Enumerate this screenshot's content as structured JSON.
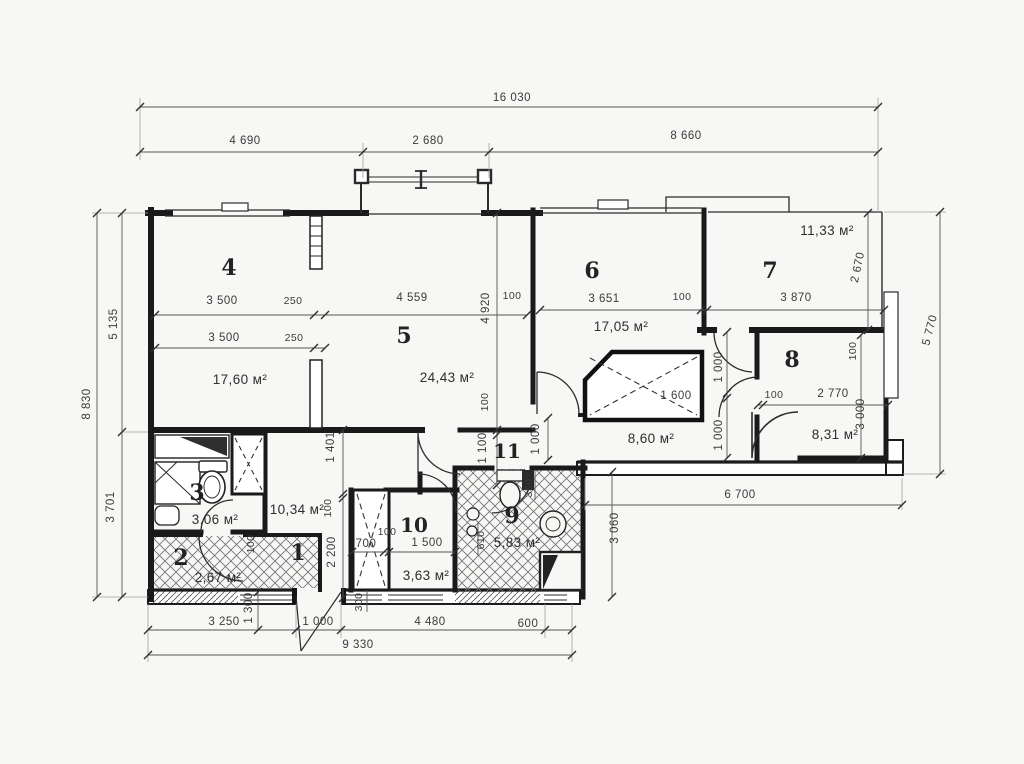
{
  "rooms": [
    {
      "number": "1",
      "area": "10,34 м²"
    },
    {
      "number": "2",
      "area": "2,67 м²"
    },
    {
      "number": "3",
      "area": "3,06 м²"
    },
    {
      "number": "4",
      "area": "17,60 м²"
    },
    {
      "number": "5",
      "area": "24,43 м²"
    },
    {
      "number": "6",
      "area": "17,05 м²"
    },
    {
      "number": "7",
      "area": "11,33 м²"
    },
    {
      "number": "8",
      "area": "8,31 м²"
    },
    {
      "number": "9",
      "area": "5,83 м²"
    },
    {
      "number": "10",
      "area": "3,63 м²"
    },
    {
      "number": "11",
      "area": "8,60 м²"
    }
  ],
  "dimensions": {
    "top": {
      "total": "16 030",
      "seg1": "4 690",
      "seg2": "2 680",
      "seg3": "8 660"
    },
    "left": {
      "total": "8 830",
      "seg1": "5 135",
      "seg2": "3 701"
    },
    "bottom": {
      "seg1": "3 250",
      "seg2": "1 000",
      "seg3": "4 480",
      "seg4": "600",
      "total": "9 330",
      "entry": "1 300",
      "niche": "300"
    },
    "right": {
      "outer": "5 770",
      "wing": "6 700",
      "depth": "3 060"
    },
    "interior": {
      "room4_width": "3 500",
      "wall_250": "250",
      "room5_width": "4 559",
      "wall_100a": "100",
      "room4_width2": "3 500",
      "wall_250b": "250",
      "room5_height": "4 920",
      "wall_100b": "100",
      "corridor_height": "1 100",
      "room6_width": "3 651",
      "wall_100c": "100",
      "room7_width": "3 870",
      "room7_height": "2 670",
      "room8_wall": "100",
      "room8_w100": "100",
      "room8_width": "2 770",
      "room8_height": "3 000",
      "closet_width": "1 600",
      "vestibule_a": "1 000",
      "vestibule_b": "1 000",
      "corridor_b": "1 000",
      "hall_a": "1 401",
      "hall_wall": "100",
      "hall_b": "2 200",
      "hall_door": "100",
      "shaft_width": "700",
      "shaft_wall": "100",
      "room10_width": "1 500",
      "room9_door": "350",
      "room9_a": "610"
    }
  }
}
